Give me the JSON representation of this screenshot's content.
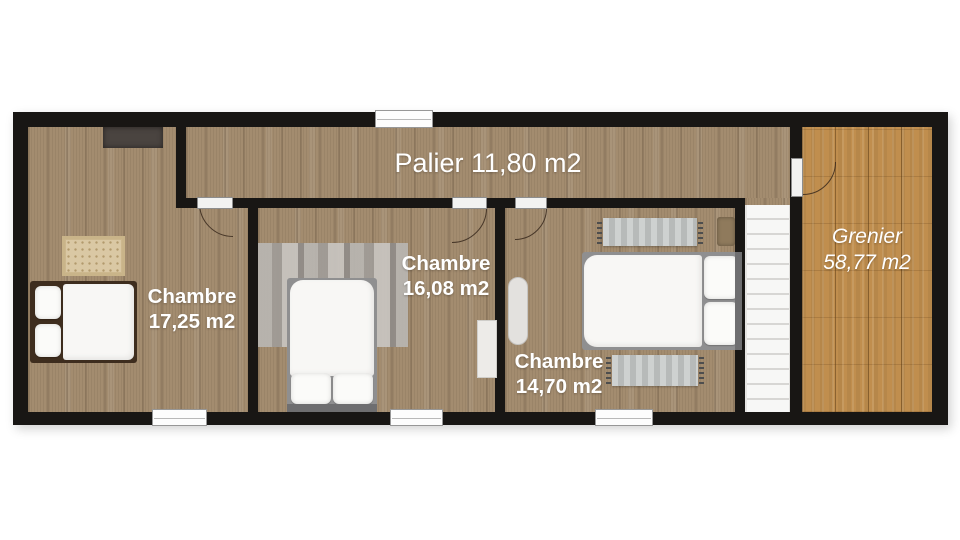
{
  "plan": {
    "background": "#ffffff",
    "wall_color": "#181614",
    "floor_color": "#a38c6f",
    "attic_floor_color": "#c08e4e",
    "stairs_color": "#f7f7f6",
    "label_color": "#ffffff"
  },
  "rooms": {
    "palier": {
      "label": "Palier 11,80 m2"
    },
    "chambre1": {
      "name": "Chambre",
      "area": "17,25 m2"
    },
    "chambre2": {
      "name": "Chambre",
      "area": "16,08 m2"
    },
    "chambre3": {
      "name": "Chambre",
      "area": "14,70 m2"
    },
    "grenier": {
      "name": "Grenier",
      "area": "58,77 m2"
    }
  }
}
